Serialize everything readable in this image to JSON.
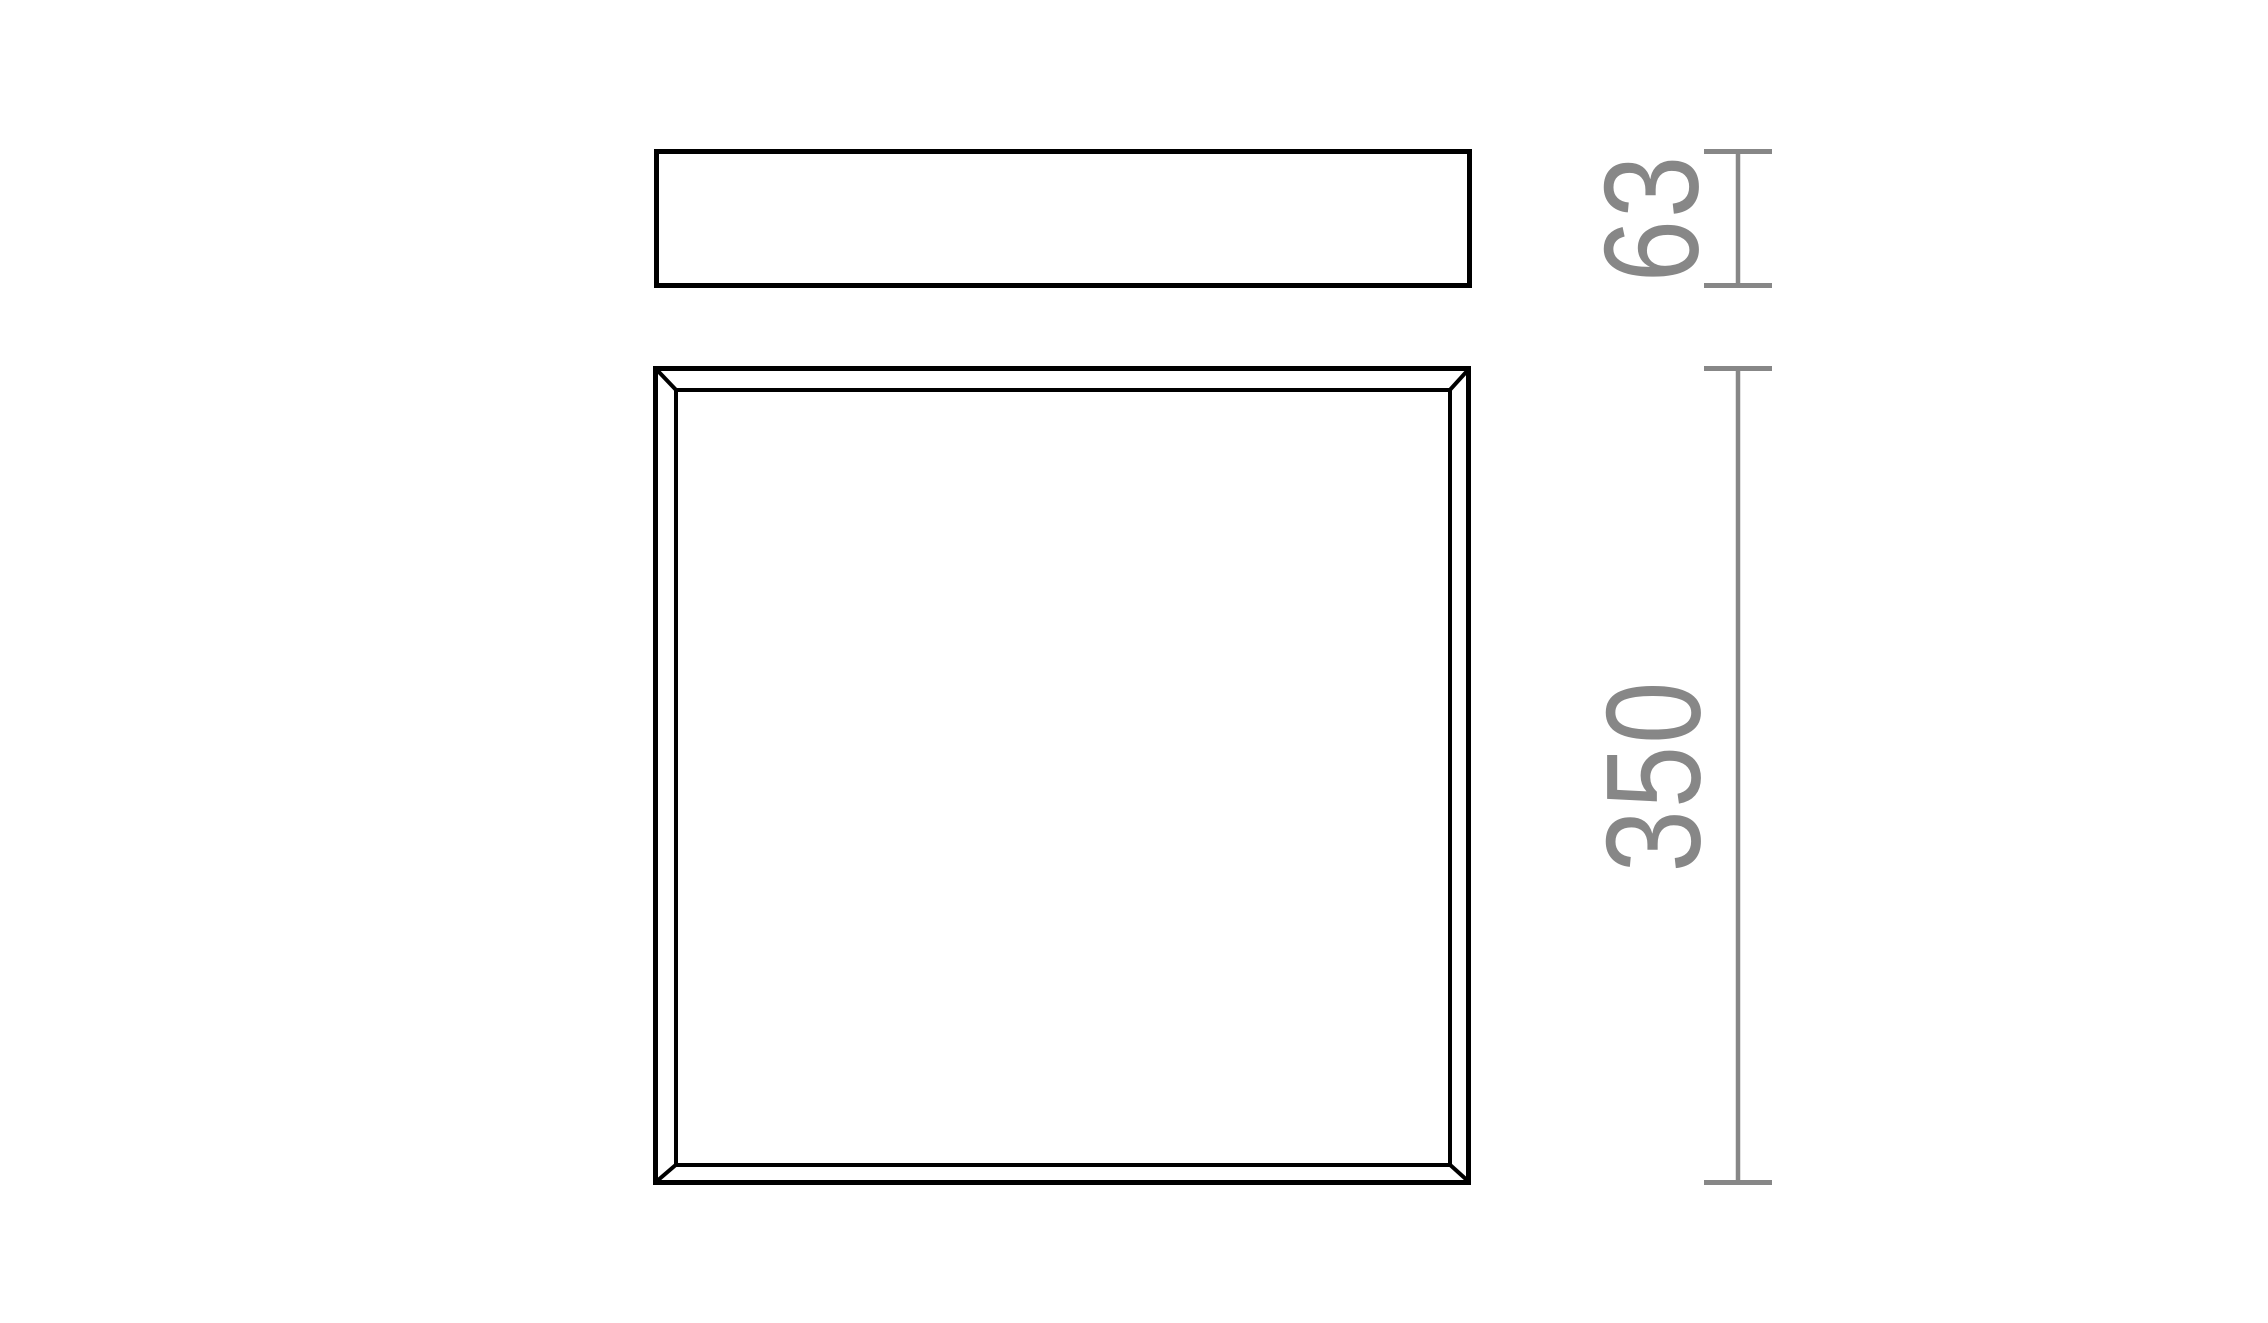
{
  "colors": {
    "background": "#ffffff",
    "outline": "#000000",
    "dimension": "#878787"
  },
  "drawing": {
    "type": "technical-dimension-drawing",
    "views": {
      "side_view": "rectangular profile (front/side elevation)",
      "plan_view": "square panel with inner frame and beveled corners (top view)"
    },
    "dimensions": {
      "side_height": {
        "label": "63"
      },
      "plan_size": {
        "label": "350"
      }
    }
  }
}
